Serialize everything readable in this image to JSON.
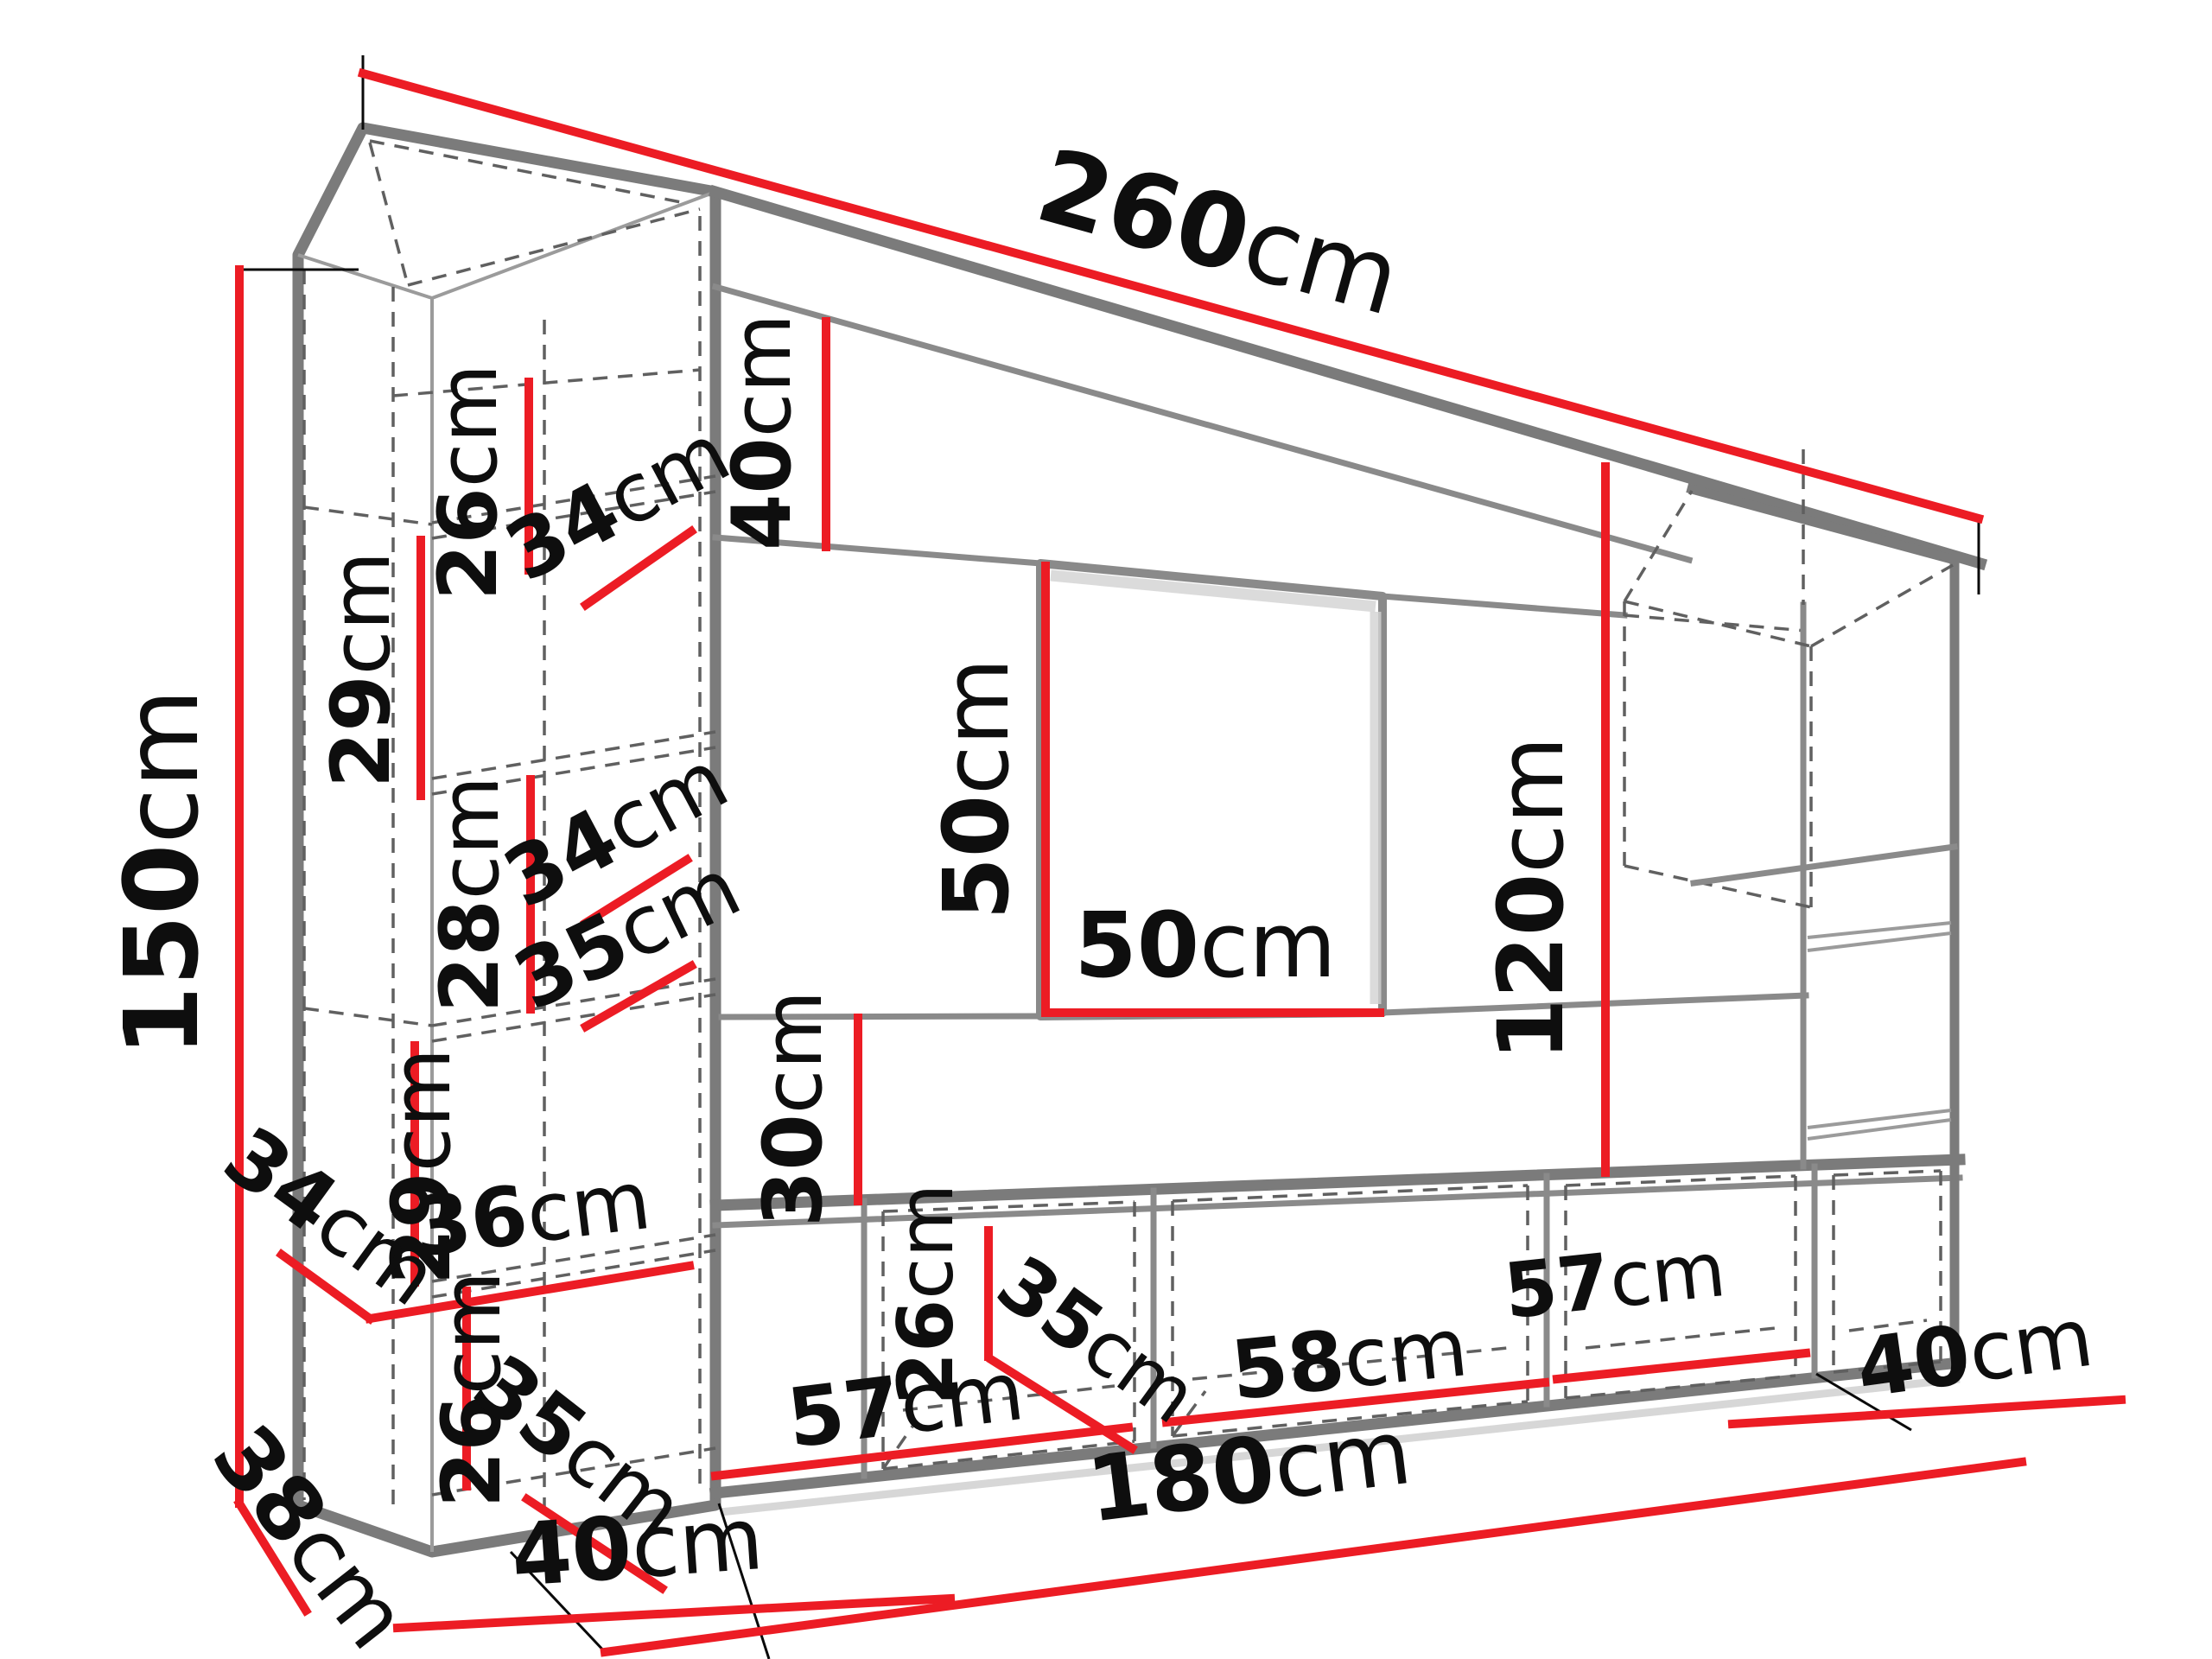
{
  "diagram": {
    "type": "furniture-dimension-drawing",
    "subject": "wall-unit entertainment center in perspective with dimension callouts",
    "unit": "cm",
    "colors": {
      "dimension_line": "#ec1c24",
      "outline": "#7b7b7b",
      "hidden_edge": "#606060",
      "label_text": "#0e0e0e",
      "background": "#ffffff"
    }
  },
  "dims": {
    "total_width": {
      "value": "260",
      "unit": "cm"
    },
    "total_height": {
      "value": "150",
      "unit": "cm"
    },
    "col_c1_h": {
      "value": "26",
      "unit": "cm"
    },
    "col_c1_w": {
      "value": "34",
      "unit": "cm"
    },
    "col_c2_h": {
      "value": "29",
      "unit": "cm"
    },
    "col_c2_w": {
      "value": "34",
      "unit": "cm"
    },
    "top_panel_h": {
      "value": "40",
      "unit": "cm"
    },
    "col_c3_h": {
      "value": "28",
      "unit": "cm"
    },
    "col_c3_w": {
      "value": "35",
      "unit": "cm"
    },
    "col_c4_h": {
      "value": "29",
      "unit": "cm"
    },
    "col_side_w": {
      "value": "34",
      "unit": "cm"
    },
    "col_c4_w": {
      "value": "36",
      "unit": "cm"
    },
    "col_c5_h": {
      "value": "26",
      "unit": "cm"
    },
    "col_c5_w": {
      "value": "35",
      "unit": "cm"
    },
    "col_depth": {
      "value": "38",
      "unit": "cm"
    },
    "col_base_w": {
      "value": "40",
      "unit": "cm"
    },
    "tv_h": {
      "value": "50",
      "unit": "cm"
    },
    "tv_w": {
      "value": "50",
      "unit": "cm"
    },
    "under_tv_h": {
      "value": "30",
      "unit": "cm"
    },
    "right_h": {
      "value": "120",
      "unit": "cm"
    },
    "bench_inner_h": {
      "value": "26",
      "unit": "cm"
    },
    "bench_depth": {
      "value": "35",
      "unit": "cm"
    },
    "bench_c1_w": {
      "value": "57",
      "unit": "cm"
    },
    "bench_c2_w": {
      "value": "58",
      "unit": "cm"
    },
    "bench_c3_w": {
      "value": "57",
      "unit": "cm"
    },
    "cube_depth": {
      "value": "40",
      "unit": "cm"
    },
    "bench_total_w": {
      "value": "180",
      "unit": "cm"
    }
  }
}
